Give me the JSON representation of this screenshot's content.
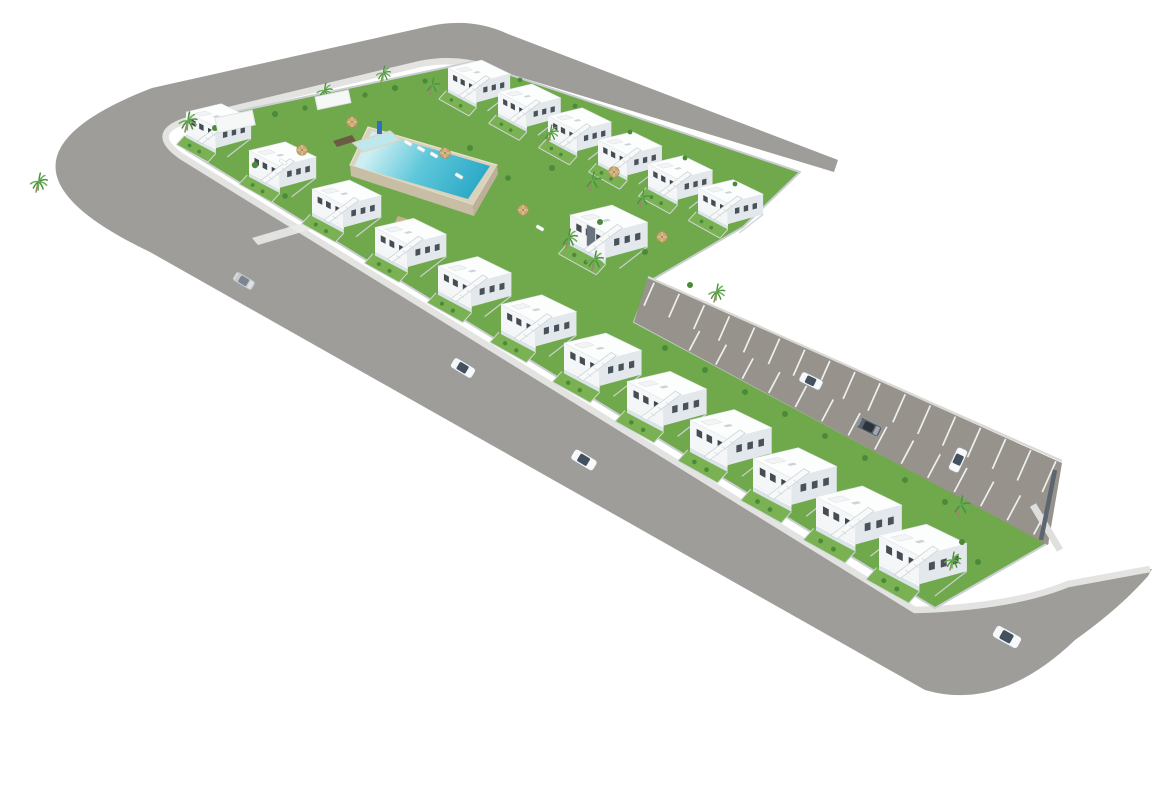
{
  "canvas": {
    "w": 1170,
    "h": 785,
    "background": "#ffffff"
  },
  "palette": {
    "road": "#9e9d99",
    "parking_asphalt": "#96918a",
    "sidewalk": "#e3e4e1",
    "lawn": "#6fa94b",
    "lawn_light": "#7ab153",
    "site_wall": "#c9ced2",
    "house_roof": "#fcfdfd",
    "house_side": "#e3e8ec",
    "house_front": "#f4f6f7",
    "window_glass": "#49525a",
    "terrace_glass": "#dbe4e8",
    "stair_white": "#f8fafa",
    "pool_deck": "#d9d2bd",
    "pool_wall_south": "#c8bda5",
    "pool_wall_east": "#bcb198",
    "pool_shallow": "#cdeff3",
    "pool_mid": "#5ec7da",
    "pool_deep": "#28a7c6",
    "kiddie_pool": "#bfe7ee",
    "umbrella": "#c9a96f",
    "palm_frond": "#4e9140",
    "palm_frond_light": "#6cae53",
    "palm_trunk": "#9b8568",
    "bush": "#4a8a38",
    "stripe": "#eef0ee",
    "parking_curb": "#d8d8d5",
    "parking_end_wall": "#5d6670",
    "parking_end_sidewalk": "#dfe0dd",
    "accent_panel": "#6a7380",
    "sign_blue": "#2f6fc0",
    "wood_deck": "#6b5b44",
    "wood_path": "#c9b089"
  },
  "road": {
    "ring_path": "M152,88 L430,26 Q472,17 508,34 L838,160 L834,172 L490,68 Q455,57 420,64 L196,118 Q144,130 181,156 L915,610 Q1012,607 1068,584 L1152,569 L1148,576 Q1120,608 1075,640 Q1000,712 925,690 L150,252 Q-40,162 152,88 Z",
    "sidewalk_path": "M490,68 Q455,57 420,64 L196,118 Q144,130 181,156 L915,610 Q1012,607 1068,584 L1150,569",
    "sidewalk_width": 6.5
  },
  "parking": {
    "poly": [
      [
        648,
        277
      ],
      [
        1062,
        463
      ],
      [
        1048,
        545
      ],
      [
        634,
        322
      ]
    ],
    "ne_edge": [
      [
        650,
        281
      ],
      [
        1060,
        463
      ]
    ],
    "sw_edge": [
      [
        636,
        322
      ],
      [
        1046,
        541
      ]
    ],
    "top_stripes": {
      "count": 17,
      "t0": 0.01,
      "t1": 0.99,
      "perp": [
        -0.404,
        0.914
      ],
      "len0": 25,
      "len1": 34
    },
    "bottom_stripes": {
      "count": 14,
      "t0": 0.13,
      "t1": 0.97,
      "perp": [
        0.469,
        -0.883
      ],
      "len0": 21,
      "len1": 29
    },
    "curb": [
      [
        648,
        277
      ],
      [
        1062,
        461
      ]
    ],
    "end_wall": [
      [
        1055,
        470
      ],
      [
        1041,
        540
      ]
    ],
    "end_sidewalk": [
      [
        1033,
        505
      ],
      [
        1060,
        550
      ]
    ]
  },
  "site": {
    "green_poly": [
      [
        186,
        150
      ],
      [
        196,
        120
      ],
      [
        472,
        62
      ],
      [
        800,
        172
      ],
      [
        743,
        227
      ],
      [
        650,
        281
      ],
      [
        634,
        322
      ],
      [
        1048,
        543
      ],
      [
        935,
        608
      ]
    ],
    "wall_width": 2
  },
  "pool": {
    "deck": [
      [
        368,
        127
      ],
      [
        497,
        165
      ],
      [
        473,
        205
      ],
      [
        350,
        165
      ]
    ],
    "water": [
      [
        372,
        131
      ],
      [
        490,
        166
      ],
      [
        468,
        199
      ],
      [
        354,
        166
      ]
    ],
    "gradient": {
      "x1": 380,
      "y1": 135,
      "x2": 478,
      "y2": 196
    },
    "south_wall": [
      [
        350,
        165
      ],
      [
        473,
        205
      ],
      [
        474,
        216
      ],
      [
        351,
        176
      ]
    ],
    "east_wall": [
      [
        473,
        205
      ],
      [
        497,
        165
      ],
      [
        498,
        174
      ],
      [
        474,
        216
      ]
    ],
    "kiddie": [
      [
        353,
        143
      ],
      [
        390,
        131
      ],
      [
        400,
        140
      ],
      [
        363,
        152
      ]
    ],
    "sign": {
      "x": 377,
      "y": 121,
      "w": 5,
      "h": 13
    },
    "wood_decks": [
      [
        [
          333,
          141
        ],
        [
          352,
          135
        ],
        [
          356,
          141
        ],
        [
          337,
          147
        ]
      ],
      [
        [
          398,
          216
        ],
        [
          432,
          227
        ],
        [
          429,
          233
        ],
        [
          395,
          222
        ]
      ]
    ],
    "light_path": [
      [
        252,
        238
      ],
      [
        330,
        215
      ],
      [
        336,
        222
      ],
      [
        258,
        245
      ]
    ]
  },
  "houses": {
    "template": {
      "garden": [
        [
          -2,
          27
        ],
        [
          34,
          47
        ],
        [
          25,
          57
        ],
        [
          -11,
          37
        ]
      ],
      "garden_walls": [
        [
          [
            -2,
            27
          ],
          [
            -11,
            37
          ]
        ],
        [
          [
            34,
            47
          ],
          [
            25,
            57
          ]
        ],
        [
          [
            -11,
            37
          ],
          [
            25,
            57
          ]
        ]
      ],
      "side": [
        [
          74,
          7
        ],
        [
          34,
          17.5
        ],
        [
          34,
          41
        ],
        [
          74,
          30
        ]
      ],
      "front": [
        [
          0,
          0
        ],
        [
          34,
          17.5
        ],
        [
          34,
          41
        ],
        [
          0,
          23
        ]
      ],
      "roof": [
        [
          0,
          0
        ],
        [
          40,
          -9.5
        ],
        [
          74,
          7
        ],
        [
          34,
          17.5
        ]
      ],
      "roof_box": [
        [
          10,
          1.5
        ],
        [
          22,
          -1
        ],
        [
          29,
          2.2
        ],
        [
          17,
          4.8
        ]
      ],
      "ac": [
        [
          30,
          5
        ],
        [
          36,
          3.6
        ],
        [
          39,
          5.2
        ],
        [
          33,
          6.6
        ]
      ],
      "side_windows": [
        [
          42,
          23
        ],
        [
          52,
          20.5
        ],
        [
          62,
          18
        ]
      ],
      "front_windows": [
        [
          6,
          8
        ],
        [
          15,
          12.6
        ]
      ],
      "door": [
        [
          25,
          18
        ],
        [
          29,
          20
        ],
        [
          29,
          27.5
        ],
        [
          25,
          25.5
        ]
      ],
      "terrace": [
        [
          0,
          23
        ],
        [
          34,
          41
        ],
        [
          34,
          47
        ],
        [
          0,
          29
        ]
      ],
      "terrace_top": [
        [
          0,
          23
        ],
        [
          34,
          41
        ],
        [
          34,
          42.8
        ],
        [
          0,
          24.8
        ]
      ],
      "stair": [
        [
          13,
          33
        ],
        [
          45,
          9
        ],
        [
          50,
          12
        ],
        [
          18,
          36
        ]
      ],
      "stair_steps": [
        [
          [
            22,
            29
          ],
          [
            26,
            32
          ]
        ],
        [
          [
            29,
            24
          ],
          [
            33,
            27
          ]
        ],
        [
          [
            36,
            19
          ],
          [
            40,
            22
          ]
        ]
      ],
      "separator": [
        [
          74,
          30
        ],
        [
          47,
          51
        ]
      ],
      "bushes": [
        [
          4,
          38
        ],
        [
          15,
          45
        ]
      ],
      "panel": [
        [
          16,
          9
        ],
        [
          24,
          13
        ],
        [
          24,
          33
        ],
        [
          16,
          29
        ]
      ]
    },
    "rows": [
      {
        "name": "north-row",
        "x0": 448,
        "y0": 68,
        "dx": 50,
        "dy": 24,
        "count": 6,
        "f0": 0.84,
        "df": 0.008
      },
      {
        "name": "street-row",
        "x0": 186,
        "y0": 112,
        "dx": 63,
        "dy": 38.5,
        "count": 12,
        "f0": 0.88,
        "df": 0.028
      }
    ],
    "middle_building": {
      "x": 570,
      "y": 215,
      "f": 1.05
    }
  },
  "flora": {
    "palms": [
      [
        185,
        132,
        1.0
      ],
      [
        36,
        192,
        0.95
      ],
      [
        322,
        100,
        0.85
      ],
      [
        381,
        82,
        0.8
      ],
      [
        430,
        94,
        0.8
      ],
      [
        548,
        142,
        0.85
      ],
      [
        590,
        190,
        0.9
      ],
      [
        566,
        248,
        0.95
      ],
      [
        592,
        270,
        0.95
      ],
      [
        640,
        207,
        0.85
      ],
      [
        714,
        302,
        0.9
      ],
      [
        958,
        516,
        1.0
      ],
      [
        950,
        570,
        0.9
      ]
    ],
    "bushes": [
      [
        215,
        128,
        3
      ],
      [
        245,
        121,
        2.6
      ],
      [
        275,
        114,
        3
      ],
      [
        305,
        108,
        2.6
      ],
      [
        335,
        101,
        3
      ],
      [
        365,
        95,
        2.6
      ],
      [
        395,
        88,
        3
      ],
      [
        425,
        81,
        2.6
      ],
      [
        255,
        165,
        3.2
      ],
      [
        285,
        196,
        2.8
      ],
      [
        470,
        148,
        3
      ],
      [
        508,
        178,
        2.8
      ],
      [
        552,
        168,
        3
      ],
      [
        600,
        222,
        3
      ],
      [
        645,
        252,
        3
      ],
      [
        690,
        285,
        3
      ],
      [
        520,
        80,
        2.4
      ],
      [
        575,
        106,
        2.4
      ],
      [
        630,
        132,
        2.4
      ],
      [
        685,
        158,
        2.4
      ],
      [
        735,
        184,
        2.4
      ],
      [
        665,
        348,
        3
      ],
      [
        705,
        370,
        3
      ],
      [
        745,
        392,
        3
      ],
      [
        785,
        414,
        3
      ],
      [
        825,
        436,
        3
      ],
      [
        865,
        458,
        3
      ],
      [
        905,
        480,
        3
      ],
      [
        945,
        502,
        3
      ],
      [
        962,
        542,
        3
      ],
      [
        978,
        562,
        3
      ]
    ]
  },
  "furniture": {
    "umbrellas": [
      [
        302,
        150
      ],
      [
        352,
        122
      ],
      [
        445,
        153
      ],
      [
        523,
        210
      ],
      [
        614,
        172
      ],
      [
        662,
        237
      ]
    ],
    "loungers": [
      [
        408,
        143
      ],
      [
        421,
        149
      ],
      [
        434,
        155
      ],
      [
        459,
        176
      ],
      [
        540,
        228
      ],
      [
        283,
        162
      ]
    ],
    "lounger_angle": 31,
    "pergolas": [
      [
        215,
        118,
        38,
        15,
        -12
      ],
      [
        315,
        97,
        34,
        13,
        -12
      ]
    ]
  },
  "cars": [
    [
      244,
      281,
      31,
      0.85,
      "silver"
    ],
    [
      463,
      368,
      31,
      0.95,
      "white"
    ],
    [
      584,
      460,
      31,
      1.0,
      "white"
    ],
    [
      1007,
      637,
      29,
      1.1,
      "white"
    ],
    [
      811,
      381,
      26,
      0.9,
      "white"
    ],
    [
      869,
      427,
      26,
      0.95,
      "dark"
    ],
    [
      958,
      460,
      115,
      0.95,
      "white"
    ]
  ],
  "car_colors": {
    "silver": [
      "#c6cacf",
      "#7c858d"
    ],
    "white": [
      "#f5f7f8",
      "#425060"
    ],
    "dark": [
      "#5a626c",
      "#2c333b"
    ]
  }
}
